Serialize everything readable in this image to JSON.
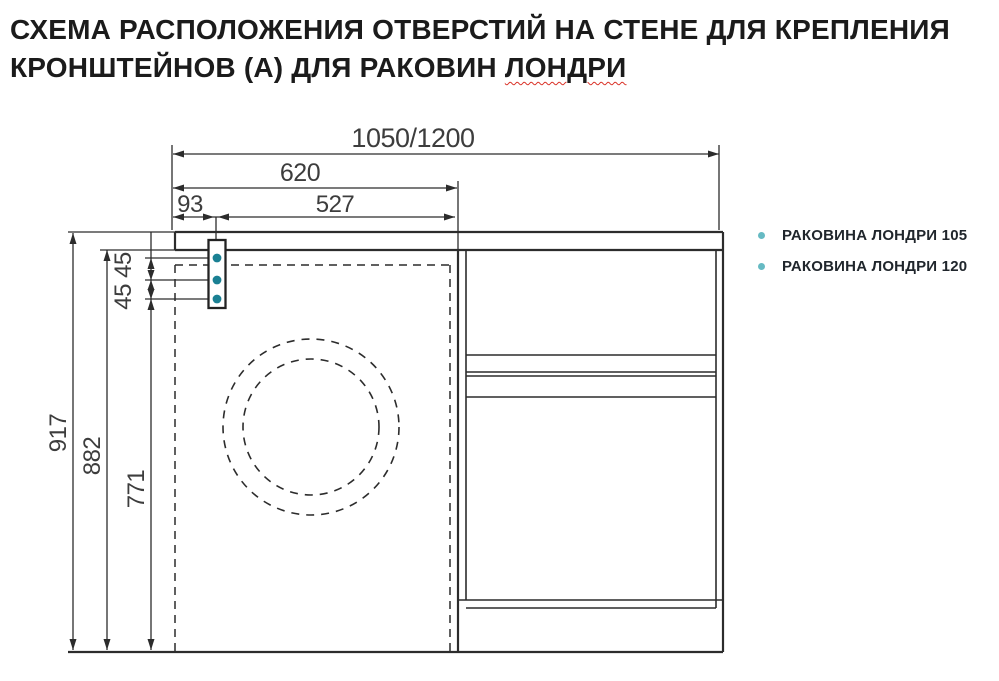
{
  "title": {
    "line1": "СХЕМА РАСПОЛОЖЕНИЯ ОТВЕРСТИЙ НА СТЕНЕ ДЛЯ КРЕПЛЕНИЯ",
    "line2_prefix": "КРОНШТЕЙНОВ (А) ДЛЯ РАКОВИН ",
    "line2_underlined": "ЛОНДРИ"
  },
  "drawing": {
    "dim_total_width": "1050/1200",
    "dim_620": "620",
    "dim_93": "93",
    "dim_527": "527",
    "dim_917": "917",
    "dim_882": "882",
    "dim_771": "771",
    "dim_45_45": "45 45",
    "colors": {
      "line": "#2c2c2c",
      "hole_fill": "#1a8093",
      "bullet_fill": "#66bac3",
      "spellcheck_underline": "#d93025"
    }
  },
  "legend": {
    "items": [
      {
        "label": "РАКОВИНА ЛОНДРИ 105"
      },
      {
        "label": "РАКОВИНА ЛОНДРИ 120"
      }
    ]
  }
}
